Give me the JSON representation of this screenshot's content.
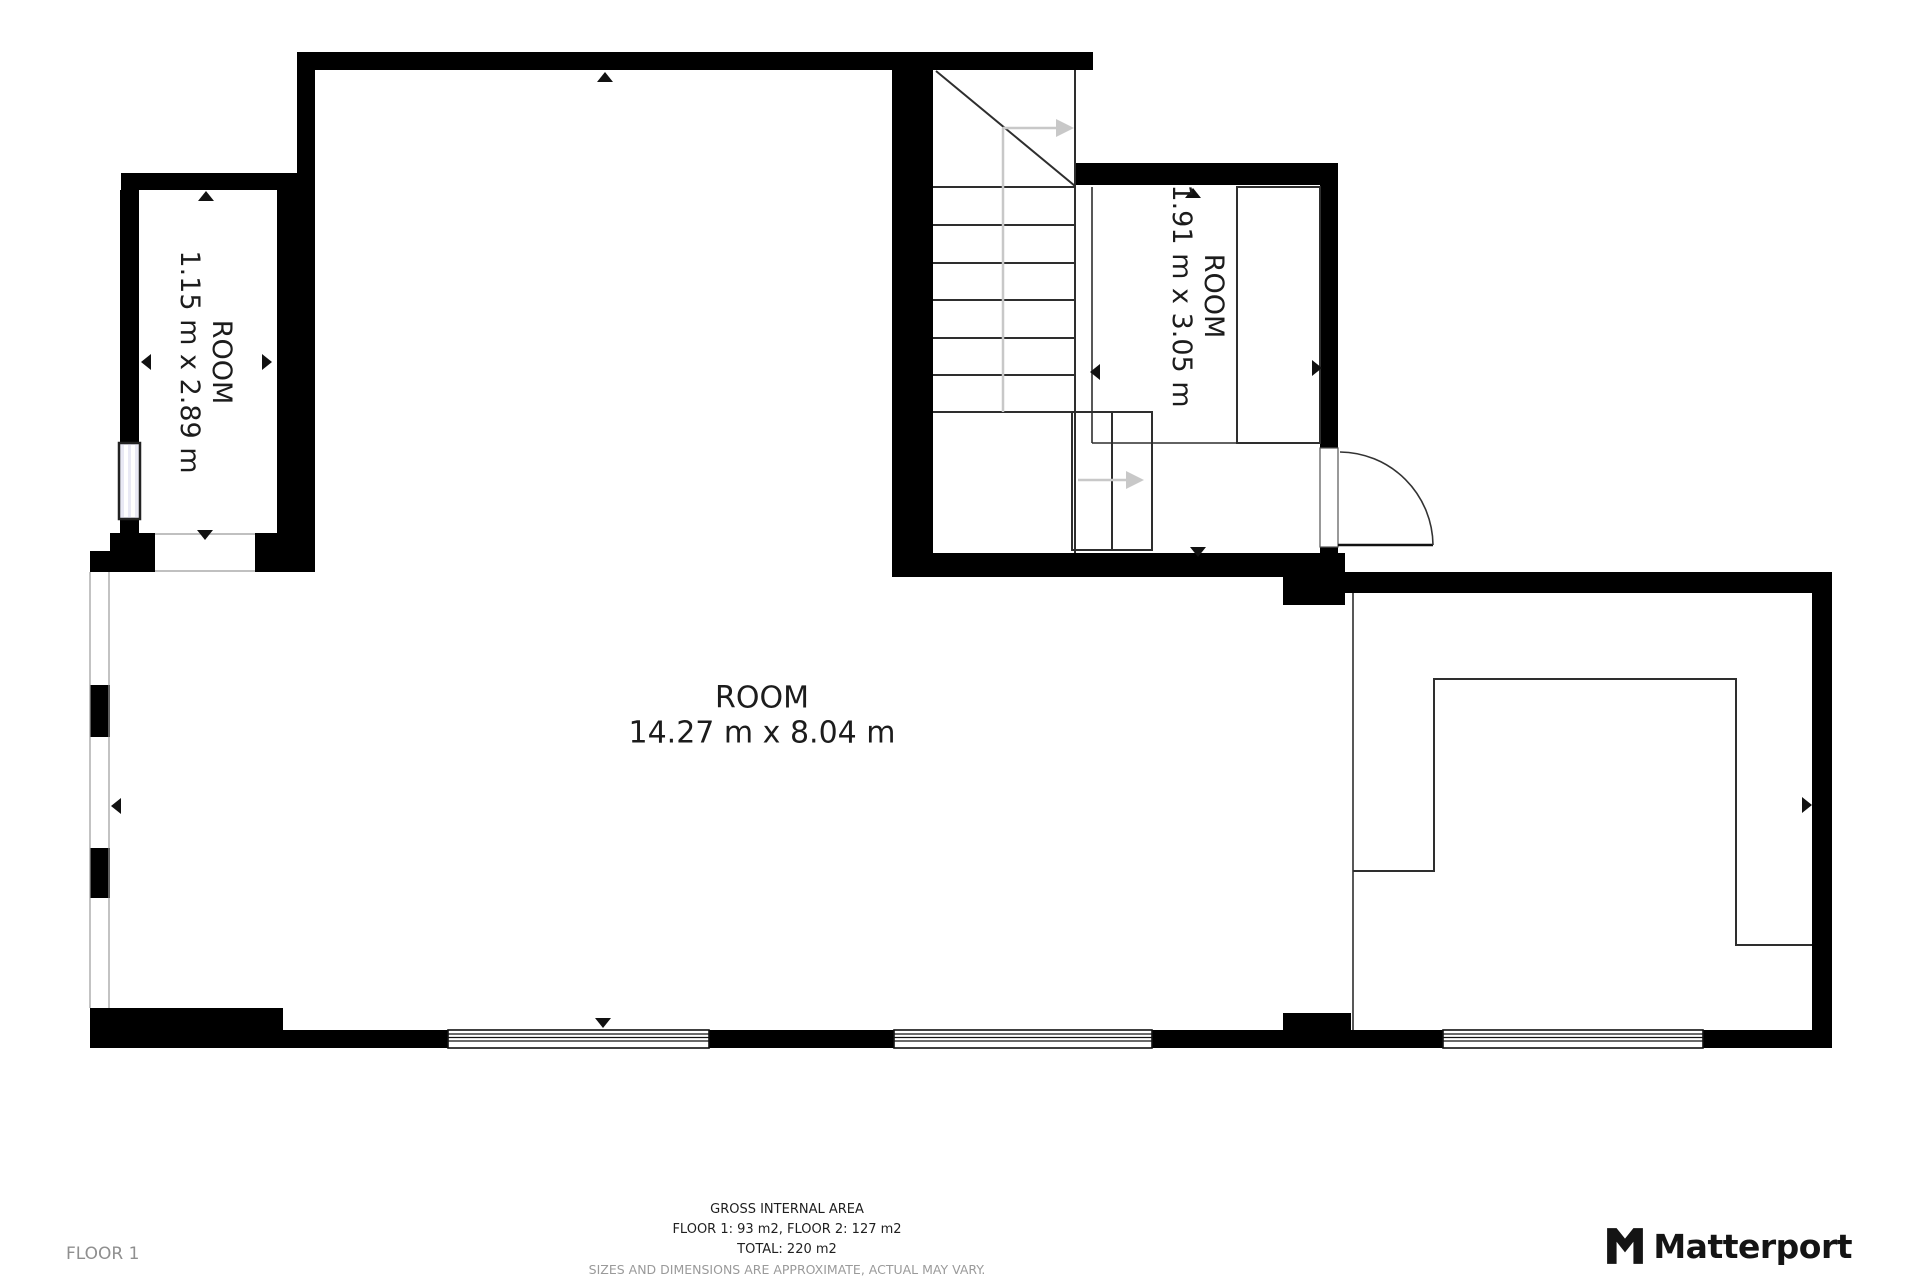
{
  "rooms": {
    "main": {
      "name": "ROOM",
      "dims": "14.27 m x 8.04 m"
    },
    "left": {
      "name": "ROOM",
      "dims": "1.15 m x 2.89 m"
    },
    "right": {
      "name": "ROOM",
      "dims": "1.91 m x 3.05 m"
    }
  },
  "floor_label": "FLOOR 1",
  "footer": {
    "title": "GROSS INTERNAL AREA",
    "floors": "FLOOR 1: 93 m2, FLOOR 2: 127 m2",
    "total": "TOTAL: 220 m2",
    "disclaimer": "SIZES AND DIMENSIONS ARE APPROXIMATE, ACTUAL MAY VARY."
  },
  "brand": {
    "name": "Matterport"
  },
  "colors": {
    "wall": "#000000",
    "line": "#2e2e2e",
    "walk_line": "#c8c8c8",
    "window_tint": "#e9e9f5",
    "text": "#1c1c1c",
    "muted": "#9a9a9a"
  }
}
